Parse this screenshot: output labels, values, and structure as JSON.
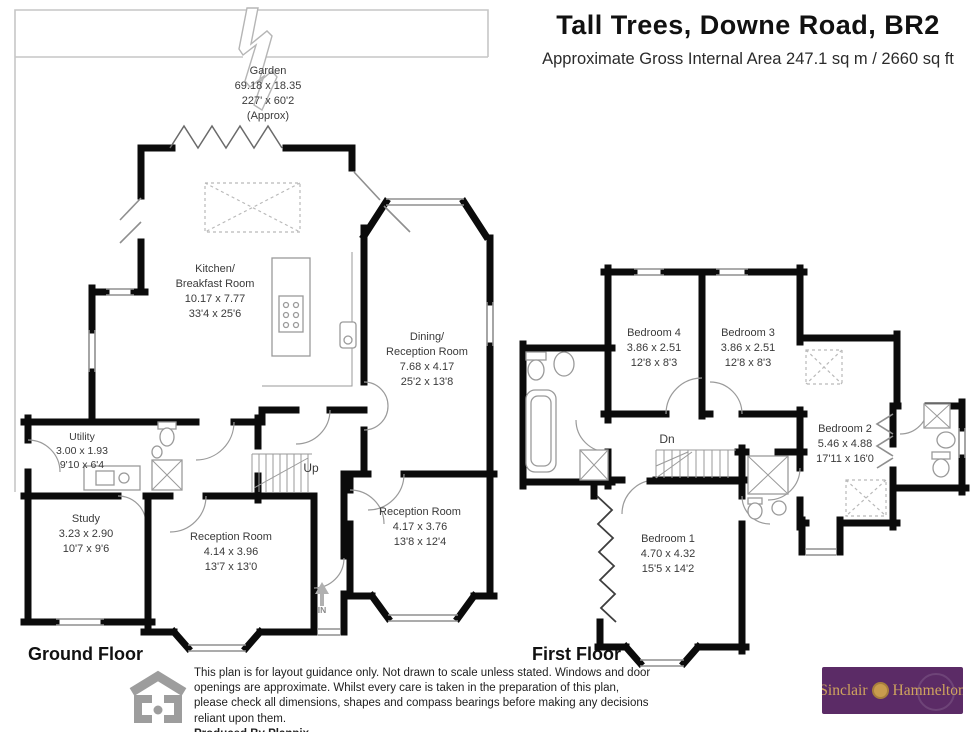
{
  "header": {
    "title": "Tall Trees, Downe Road, BR2",
    "subtitle": "Approximate Gross Internal Area 247.1 sq m / 2660 sq ft"
  },
  "ground_floor": {
    "label": "Ground Floor",
    "stairs_label": "Up",
    "entrance_label": "IN",
    "rooms": {
      "garden": {
        "name": "Garden",
        "metric": "69.18 x 18.35",
        "imperial": "227' x 60'2",
        "note": "(Approx)"
      },
      "kitchen": {
        "name": "Kitchen/\nBreakfast Room",
        "metric": "10.17 x 7.77",
        "imperial": "33'4 x 25'6"
      },
      "dining": {
        "name": "Dining/\nReception Room",
        "metric": "7.68 x 4.17",
        "imperial": "25'2 x 13'8"
      },
      "utility": {
        "name": "Utility",
        "metric": "3.00 x 1.93",
        "imperial": "9'10 x 6'4"
      },
      "study": {
        "name": "Study",
        "metric": "3.23 x 2.90",
        "imperial": "10'7 x 9'6"
      },
      "reception1": {
        "name": "Reception Room",
        "metric": "4.14 x 3.96",
        "imperial": "13'7 x 13'0"
      },
      "reception2": {
        "name": "Reception Room",
        "metric": "4.17 x 3.76",
        "imperial": "13'8 x 12'4"
      }
    }
  },
  "first_floor": {
    "label": "First Floor",
    "stairs_label": "Dn",
    "rooms": {
      "bedroom1": {
        "name": "Bedroom 1",
        "metric": "4.70 x 4.32",
        "imperial": "15'5 x 14'2"
      },
      "bedroom2": {
        "name": "Bedroom 2",
        "metric": "5.46 x 4.88",
        "imperial": "17'11 x 16'0"
      },
      "bedroom3": {
        "name": "Bedroom 3",
        "metric": "3.86 x 2.51",
        "imperial": "12'8 x 8'3"
      },
      "bedroom4": {
        "name": "Bedroom 4",
        "metric": "3.86 x 2.51",
        "imperial": "12'8 x 8'3"
      }
    }
  },
  "footer": {
    "disclaimer": "This plan is for layout guidance only. Not drawn to scale unless stated. Windows and door openings are approximate. Whilst every care is taken in the preparation of this plan, please check all dimensions, shapes and compass bearings before making any decisions reliant upon them.",
    "produced_by": "Produced By Planpix",
    "agent_logo": {
      "name_left": "Sinclair",
      "name_right": "Hammelton"
    }
  },
  "colors": {
    "wall": "#0b0b0b",
    "fixture_line": "#9a9a9a",
    "garden_line": "#c6c6c6",
    "logo_background": "#5b2b66",
    "logo_text": "#cfa45e",
    "planpix_grey": "#9d9d9d"
  }
}
